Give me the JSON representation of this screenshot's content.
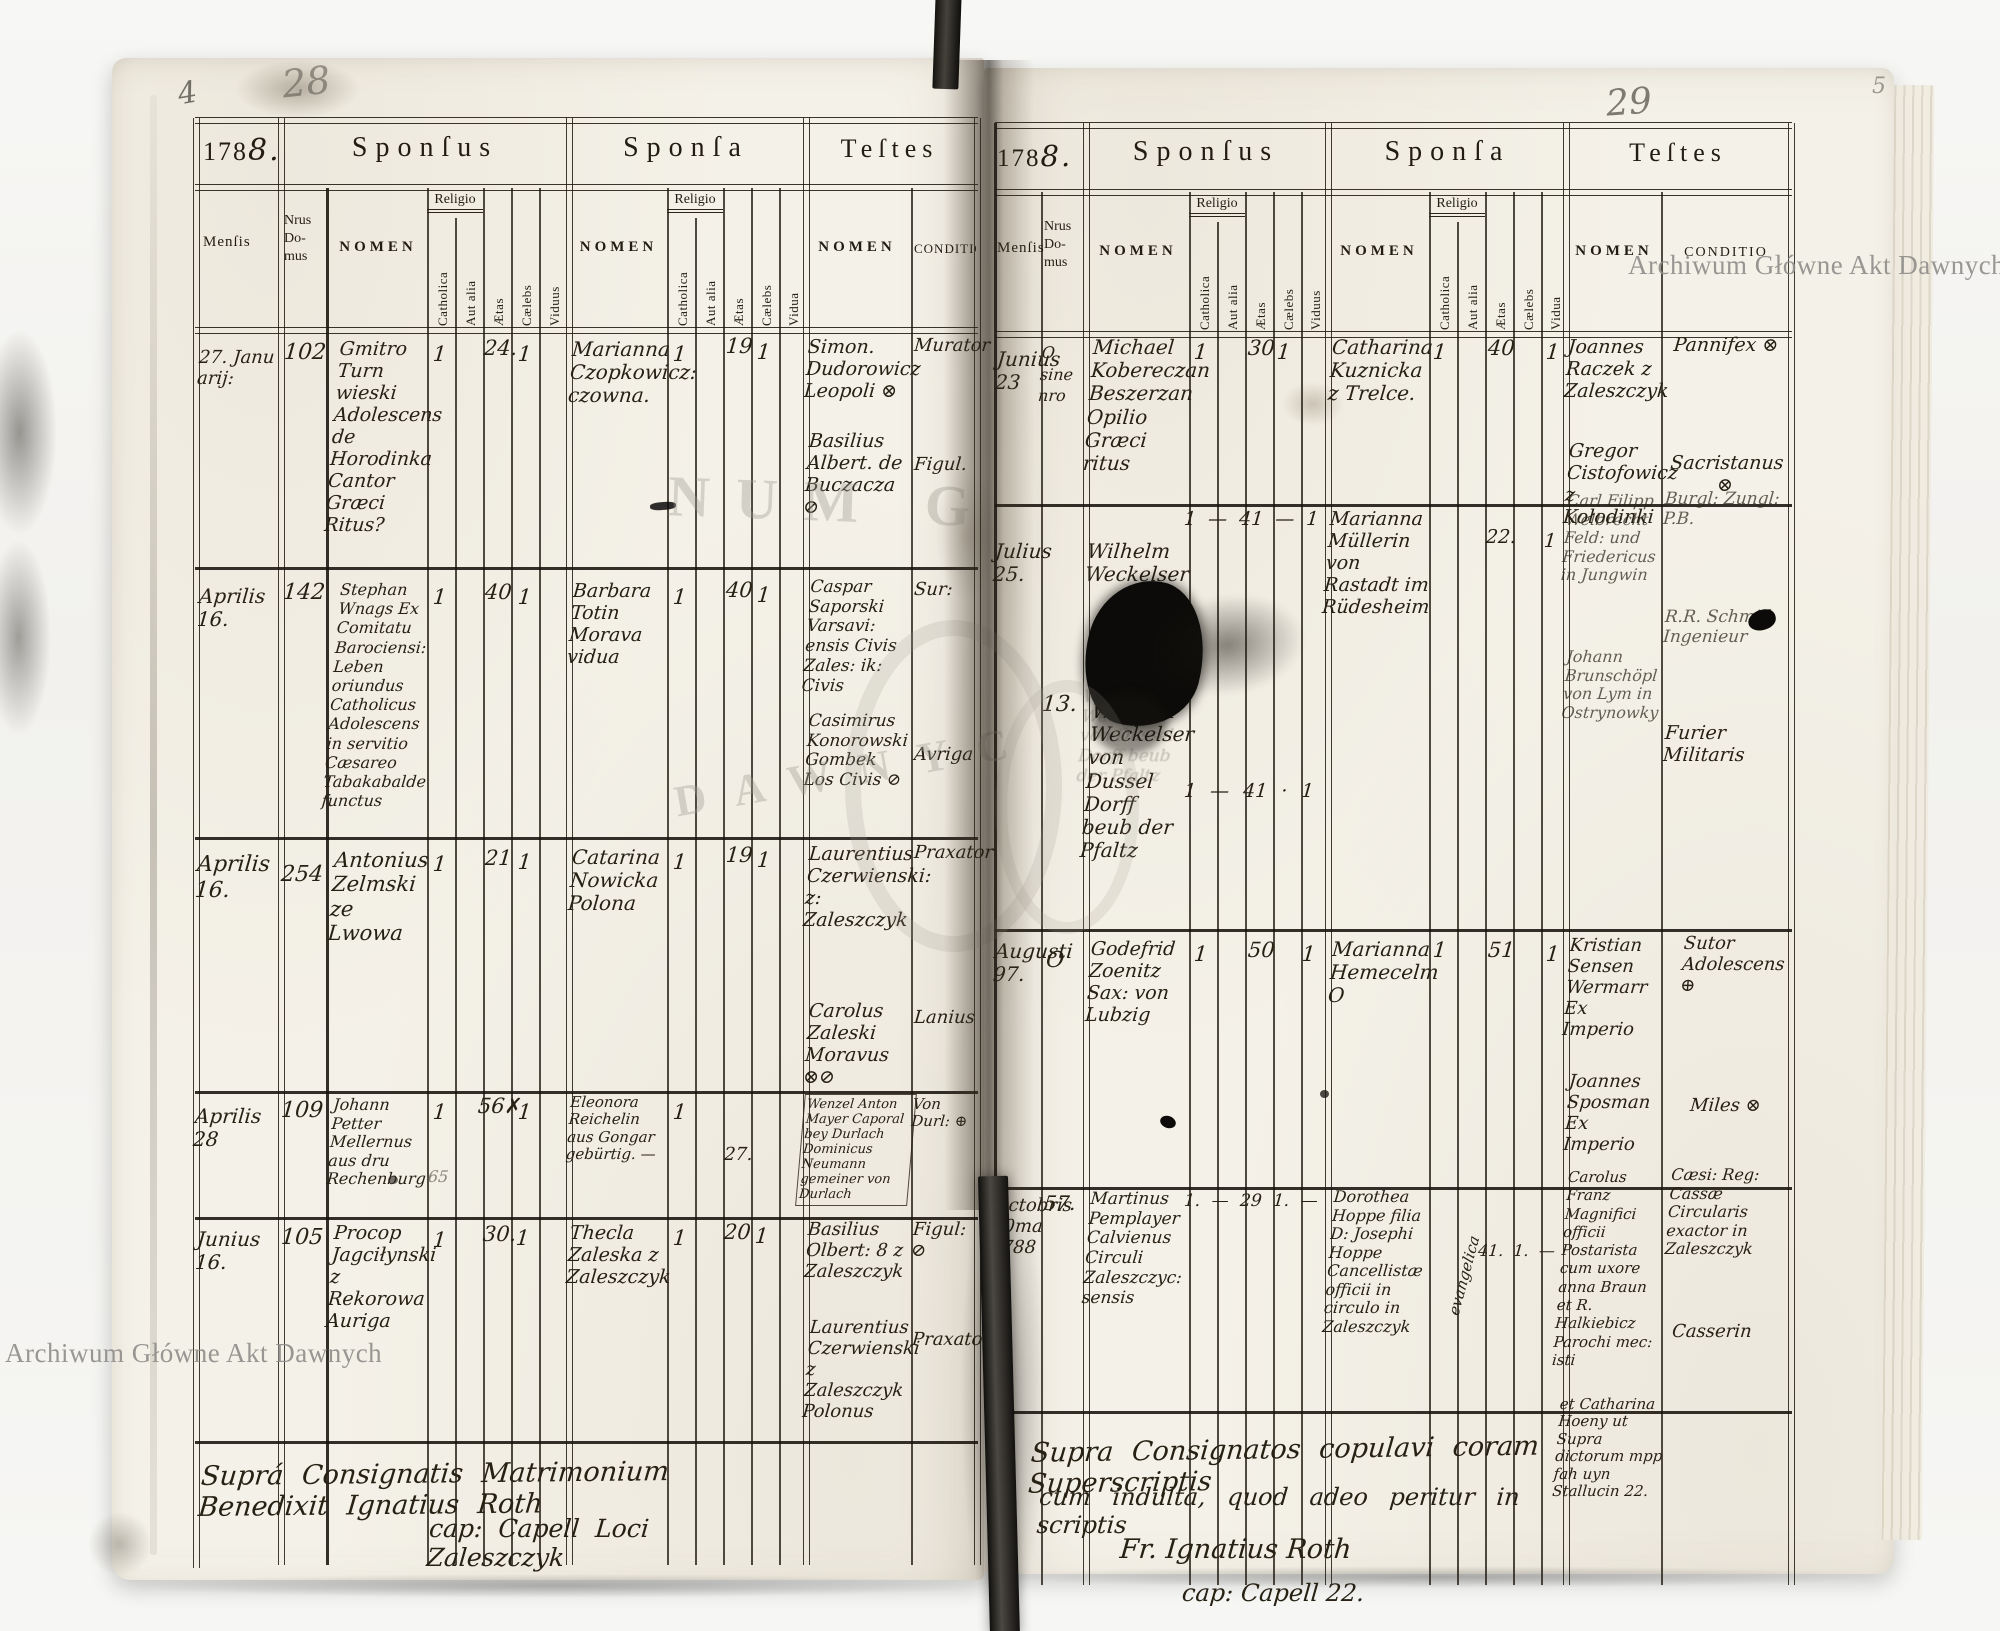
{
  "wm": "Archiwum Główne Akt Dawnych",
  "ghost": {
    "a": "NUM G",
    "b": "DAWNYC"
  },
  "marg": {
    "a": "4",
    "b": "28",
    "c": "29",
    "d": "5"
  },
  "hdr": {
    "year": "178",
    "year8": "8.",
    "sponsus": "Sponſus",
    "sponsa": "Sponſa",
    "testes": "Teſtes",
    "mensis": "Menſis",
    "nrus": "Nrus Do- mus",
    "nomen": "NOMEN",
    "religio": "Religio",
    "catholica": "Catholica",
    "aut_alia": "Aut alia",
    "aetas": "Ætas",
    "caelebs": "Cælebs",
    "viduus": "Viduus",
    "vidua": "Vidua",
    "conditio": "CONDITIO"
  },
  "L": {
    "rows": [
      {
        "ms": "27. Janu arij:",
        "nr": "102",
        "sn": "Gmitro Turn wieski Adolescens de Horodinka Cantor Græci Ritus?",
        "sc": "1",
        "sae": "24.",
        "scl": "1",
        "an": "Marianna Czopkowicz: czowna.",
        "ac": "1",
        "aae": "19",
        "acl": "1",
        "tn": "Simon. Dudorowicz Leopoli ⊗",
        "tn2": "Basilius Albert. de Buczacza ⊘",
        "c1": "Murator",
        "c2": "Figul."
      },
      {
        "ms": "Aprilis 16.",
        "nr": "142",
        "sn": "Stephan Wnags Ex Comitatu Barociensi: Leben oriundus Catholicus Adolescens in servitio Cæsareo Tabakabalde functus",
        "sc": "1",
        "sae": "40",
        "scl": "1",
        "an": "Barbara Totin Morava vidua",
        "ac": "1",
        "aae": "40",
        "acl": "1",
        "tn": "Caspar Saporski Varsavi: ensis Civis Zales: ik: Civis",
        "tn2": "Casimirus Konorowski Gombek Los Civis ⊘",
        "c1": "Sur:",
        "c2": "Avriga"
      },
      {
        "ms": "Aprilis 16.",
        "nr": "254",
        "sn": "Antonius Zelmski ze Lwowa",
        "sc": "1",
        "sae": "21",
        "scl": "1",
        "an": "Catarina Nowicka Polona",
        "ac": "1",
        "aae": "19",
        "acl": "1",
        "tn": "Laurentius Czerwienski: z: Zaleszczyk",
        "tn2": "Carolus Zaleski Moravus ⊗⊘",
        "c1": "Praxator",
        "c2": "Lanius"
      },
      {
        "ms": "Aprilis 28",
        "nr": "109",
        "sn": "Johann Petter Mellernus aus dru Rechenburg",
        "sc": "1",
        "sae": "56✗",
        "scl": "1",
        "pencil": "65",
        "an": "Eleonora Reichelin aus Gongar gebürtig. —",
        "ac": "1",
        "aae": "27.",
        "tn": "Wenzel Anton Mayer Caporal bey Durlach Dominicus Neumann gemeiner von Durlach",
        "c1": "Von Durl: ⊕"
      },
      {
        "ms": "Junius 16.",
        "nr": "105",
        "sn": "Procop Jagciłynski z Rekorowa Auriga",
        "sc": "1",
        "sae": "30.",
        "scl": "1",
        "an": "Thecla Zaleska z Zaleszczyk",
        "ac": "1",
        "aae": "20",
        "acl": "1",
        "tn": "Basilius Olbert: 8 z Zaleszczyk",
        "tn2": "Laurentius Czerwienski z Zaleszczyk Polonus",
        "c1": "Figul: ⊘",
        "c2": "Praxator"
      }
    ],
    "foot1": "Suprá Consignatis Matrimonium Benedixit Ignatius Roth",
    "foot2": "cap: Capell Loci Zaleszczyk"
  },
  "R": {
    "rows": [
      {
        "ms": "Junius 23",
        "nr": "O sine nro",
        "sn": "Michael Kobereczan Beszerzan Opilio Græci ritus",
        "sc": "1",
        "sae": "30",
        "scl": "1",
        "an": "Catharina Kuznicka z Trelce.",
        "ac": "1",
        "aae": "40",
        "acl": "1",
        "tn": "Joannes Raczek z Zaleszczyk",
        "tn2": "Gregor Cistofowicz z Kołodinki",
        "c1": "Pannifex ⊗",
        "c2": "Sacristanus ⊗"
      },
      {
        "ms": "Julius 25.",
        "nr": "13.",
        "sn": "Wilhelm Weckelser",
        "sn2": "Wilhelm Weckelser von Dussel Dorff beub der Pfaltz",
        "mt": "1 — 41 — 1",
        "mb": "1 — 41 · 1",
        "an": "Marianna Müllerin von Rastadt im Rüdesheim",
        "aae": "22.",
        "acl": "1",
        "tn": "Carl Filipp Welbrecht Feld: und Friedericus in Jungwin",
        "tn2": "Johann Brunschöpl von Lym in Ostrynowky",
        "c1": "Burgl: Zungl: P.B.",
        "c2": "R.R. Schmid Ingenieur",
        "c3": "Furier Militaris"
      },
      {
        "ms": "Augusti 97.",
        "nr": "O",
        "sn": "Godefrid Zoenitz Sax: von Lubzig",
        "sc": "1",
        "sae": "50",
        "sv": "1",
        "an": "Marianna Hemecelm O",
        "ac": "1",
        "aae": "51",
        "av": "1",
        "tn": "Kristian Sensen Wermarr Ex Imperio",
        "tn2": "Joannes Sposman Ex Imperio",
        "c1": "Sutor Adolescens ⊕",
        "c2": "Miles ⊗"
      },
      {
        "ms": "Octobris 10ma 1788",
        "nr": "57.",
        "sn": "Martinus Pemplayer Calvienus Circuli Zaleszczyc: sensis",
        "mt": "1. — 29 1. —",
        "an": "Dorothea Hoppe filia D: Josephi Hoppe Cancellistæ officii in circulo in Zaleszczyk",
        "note": "evangelica",
        "mb": "41. 1. —",
        "tn": "Carolus Franz Magnifici officii Postarista cum uxore anna Braun et R. Halkiebicz Parochi mec: isti",
        "tn2": "et Catharina Hoeny ut Supra dictorum mpp fah uyn Stallucin 22.",
        "c1": "Cæsi: Reg: Cassæ Circularis exactor in Zaleszczyk",
        "c2": "Casserin"
      }
    ],
    "foot1": "Supra Consignatos copulavi coram Superscriptis",
    "foot2": "cum indulta, quod adeo peritur in scriptis",
    "foot3": "Fr. Ignatius Roth",
    "foot4": "cap: Capell 22."
  }
}
